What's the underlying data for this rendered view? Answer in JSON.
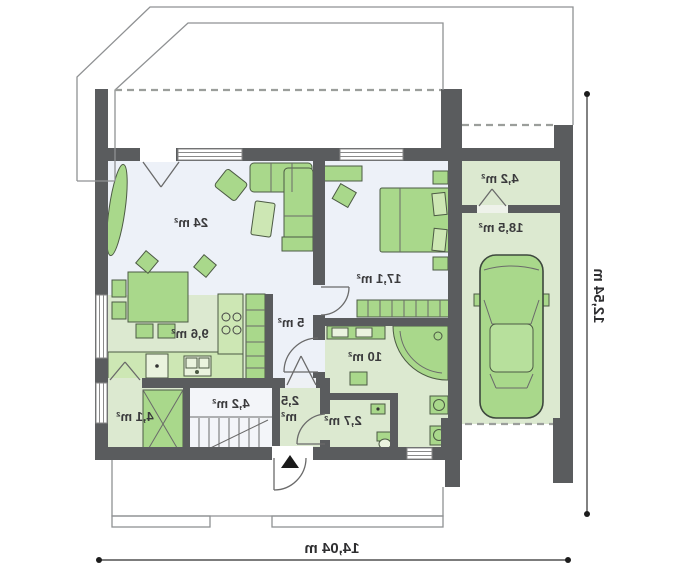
{
  "plan_title": "single-storey house floor plan (mirrored print)",
  "rooms": {
    "living": "24 m²",
    "bedroom": "17,1 m²",
    "kitchen": "9,6 m²",
    "hall": "5 m²",
    "bathroom": "10 m²",
    "wc": "2,7 m²",
    "entry_line1": "2,5",
    "entry_line2": "m²",
    "stair_room": "4,2 m²",
    "pantry": "4,1 m²",
    "utility": "4,2 m²",
    "garage": "18,5 m²"
  },
  "dimensions": {
    "total_width": "14,04 m",
    "total_height": "12,54 m"
  },
  "colors": {
    "wall": "#5a5c5e",
    "floor_green": "#dce9d0",
    "floor_blue": "#edf1f8",
    "furniture_green": "#a9d88b",
    "label_text": "#3a3a3c"
  }
}
